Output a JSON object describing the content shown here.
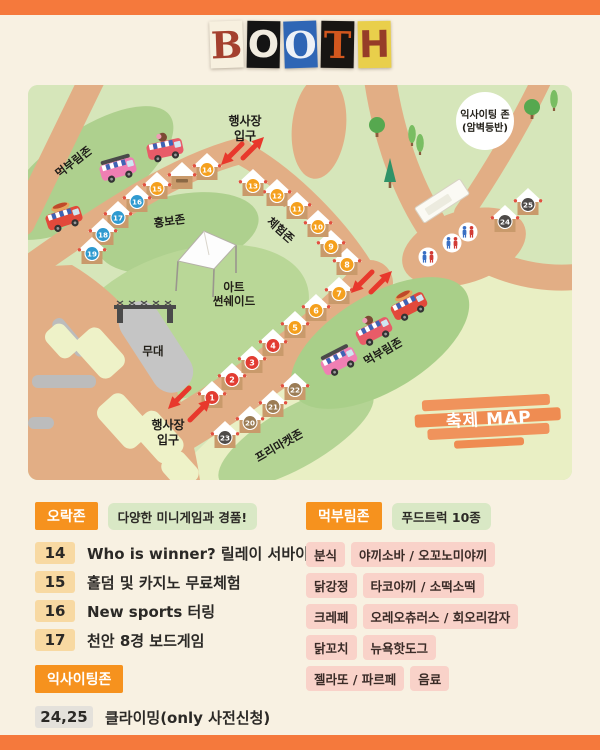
{
  "title": {
    "word": "BOOTH",
    "letters": [
      {
        "ch": "B",
        "bg": "#f7f0df",
        "fg": "#a4402e",
        "serif": true,
        "rot": -2
      },
      {
        "ch": "O",
        "bg": "#141414",
        "fg": "#f1ece0",
        "serif": false,
        "rot": 1
      },
      {
        "ch": "O",
        "bg": "#2f66b5",
        "fg": "#eef2f7",
        "serif": true,
        "rot": -2
      },
      {
        "ch": "T",
        "bg": "#181512",
        "fg": "#d2571e",
        "serif": true,
        "rot": 1
      },
      {
        "ch": "H",
        "bg": "#e9cf4b",
        "fg": "#963c28",
        "serif": false,
        "rot": -1
      }
    ]
  },
  "map": {
    "zone_labels": [
      {
        "text": "먹부림존",
        "x": 48,
        "y": 80,
        "rot": -38
      },
      {
        "text": "홍보존",
        "x": 142,
        "y": 140,
        "rot": -8
      },
      {
        "text": "체험존",
        "x": 250,
        "y": 148,
        "rot": 42
      },
      {
        "text": "프리마켓존",
        "x": 253,
        "y": 364,
        "rot": -30
      },
      {
        "text": "먹부림존",
        "x": 357,
        "y": 270,
        "rot": -30
      }
    ],
    "entrance_labels": [
      {
        "x": 217,
        "y": 40,
        "lines": [
          "행사장",
          "입구"
        ]
      },
      {
        "x": 140,
        "y": 344,
        "lines": [
          "행사장",
          "입구"
        ]
      }
    ],
    "exciting_zone": {
      "lines": [
        "익사이팅 존",
        "(암벽등반)"
      ]
    },
    "art_shade": {
      "lines": [
        "아트",
        "썬쉐이드"
      ]
    },
    "stage_label": "무대",
    "map_stamp": "축제 MAP",
    "booth_colors": {
      "red": "#e23c32",
      "orange": "#f5a01d",
      "blue": "#2f9ad0",
      "brown": "#9b7c55",
      "dark": "#4d4a48"
    },
    "booths": [
      {
        "n": "1",
        "x": 184,
        "y": 307,
        "cat": "red"
      },
      {
        "n": "2",
        "x": 204,
        "y": 289,
        "cat": "red"
      },
      {
        "n": "3",
        "x": 224,
        "y": 272,
        "cat": "red"
      },
      {
        "n": "4",
        "x": 245,
        "y": 255,
        "cat": "red"
      },
      {
        "n": "5",
        "x": 267,
        "y": 237,
        "cat": "orange"
      },
      {
        "n": "6",
        "x": 288,
        "y": 220,
        "cat": "orange"
      },
      {
        "n": "7",
        "x": 311,
        "y": 203,
        "cat": "orange"
      },
      {
        "n": "8",
        "x": 319,
        "y": 174,
        "cat": "orange"
      },
      {
        "n": "9",
        "x": 303,
        "y": 156,
        "cat": "orange"
      },
      {
        "n": "10",
        "x": 290,
        "y": 136,
        "cat": "orange"
      },
      {
        "n": "11",
        "x": 269,
        "y": 118,
        "cat": "orange"
      },
      {
        "n": "12",
        "x": 249,
        "y": 105,
        "cat": "orange"
      },
      {
        "n": "13",
        "x": 225,
        "y": 95,
        "cat": "orange"
      },
      {
        "n": "14",
        "x": 179,
        "y": 79,
        "cat": "orange"
      },
      {
        "n": "",
        "x": 154,
        "y": 88,
        "cat": ""
      },
      {
        "n": "15",
        "x": 129,
        "y": 98,
        "cat": "orange"
      },
      {
        "n": "16",
        "x": 109,
        "y": 111,
        "cat": "blue"
      },
      {
        "n": "17",
        "x": 90,
        "y": 127,
        "cat": "blue"
      },
      {
        "n": "18",
        "x": 75,
        "y": 144,
        "cat": "blue"
      },
      {
        "n": "19",
        "x": 64,
        "y": 163,
        "cat": "blue"
      },
      {
        "n": "20",
        "x": 222,
        "y": 332,
        "cat": "brown"
      },
      {
        "n": "21",
        "x": 245,
        "y": 316,
        "cat": "brown"
      },
      {
        "n": "22",
        "x": 267,
        "y": 299,
        "cat": "brown"
      },
      {
        "n": "23",
        "x": 197,
        "y": 347,
        "cat": "dark"
      },
      {
        "n": "24",
        "x": 477,
        "y": 131,
        "cat": "dark"
      },
      {
        "n": "25",
        "x": 500,
        "y": 114,
        "cat": "dark"
      }
    ],
    "food_trucks": [
      {
        "type": "bus",
        "x": 90,
        "y": 84,
        "rot": -16,
        "color": "#ef7fb3"
      },
      {
        "type": "icecream",
        "x": 137,
        "y": 64,
        "rot": -12,
        "color": "#e85b68"
      },
      {
        "type": "hotdog",
        "x": 36,
        "y": 133,
        "rot": -18,
        "color": "#e2493b"
      },
      {
        "type": "hotdog",
        "x": 381,
        "y": 221,
        "rot": -27,
        "color": "#e2493b"
      },
      {
        "type": "icecream",
        "x": 346,
        "y": 246,
        "rot": -27,
        "color": "#e85b68"
      },
      {
        "type": "bus",
        "x": 311,
        "y": 276,
        "rot": -27,
        "color": "#ef7fb3"
      }
    ],
    "trees": [
      {
        "kind": "round",
        "x": 349,
        "y": 40
      },
      {
        "kind": "cypress",
        "x": 384,
        "y": 49
      },
      {
        "kind": "cypress",
        "x": 392,
        "y": 58
      },
      {
        "kind": "pine",
        "x": 362,
        "y": 88
      },
      {
        "kind": "round",
        "x": 504,
        "y": 22
      },
      {
        "kind": "cypress",
        "x": 526,
        "y": 14
      }
    ],
    "restrooms": [
      {
        "x": 400,
        "y": 172
      },
      {
        "x": 424,
        "y": 158
      },
      {
        "x": 440,
        "y": 147
      }
    ],
    "entrance_arrows": [
      {
        "x": 203,
        "y": 70,
        "dir": "dl"
      },
      {
        "x": 226,
        "y": 62,
        "dir": "ur"
      },
      {
        "x": 333,
        "y": 198,
        "dir": "dl"
      },
      {
        "x": 354,
        "y": 196,
        "dir": "ur"
      },
      {
        "x": 150,
        "y": 314,
        "dir": "dl"
      },
      {
        "x": 173,
        "y": 324,
        "dir": "ur"
      }
    ]
  },
  "legend_left": {
    "zone_badge": "오락존",
    "zone_note": "다양한 미니게임과 경품!",
    "items": [
      {
        "num": "14",
        "text": "Who is winner? 릴레이 서바이벌!"
      },
      {
        "num": "15",
        "text": "홀덤 및 카지노 무료체험"
      },
      {
        "num": "16",
        "text": "New sports 터링"
      },
      {
        "num": "17",
        "text": "천안 8경 보드게임"
      }
    ],
    "exciting_badge": "익사이팅존",
    "exciting_item": {
      "num": "24,25",
      "text": "클라이밍(only 사전신청)"
    }
  },
  "legend_right": {
    "zone_badge": "먹부림존",
    "zone_note": "푸드트럭 10종",
    "rows": [
      [
        "분식",
        "야끼소바 / 오꼬노미야끼"
      ],
      [
        "닭강정",
        "타코야끼 / 소떡소떡"
      ],
      [
        "크레페",
        "오레오츄러스 / 회오리감자"
      ],
      [
        "닭꼬치",
        "뉴욕핫도그"
      ],
      [
        "젤라또 / 파르페",
        "음료"
      ]
    ]
  },
  "colors": {
    "page_bg": "#f8f1e2",
    "bar_orange": "#f5793c",
    "map_green": "#d6e6ba",
    "road_tan": "#e2ae85",
    "dark_green_blob": "#aed08e",
    "yellow_green": "#e9efc4",
    "badge_orange": "#f6921e",
    "badge_green": "#d9e8c5",
    "badge_pink": "#f9d2c9",
    "num_badge": "#f8d9a2",
    "arrow_red": "#e8382c"
  }
}
